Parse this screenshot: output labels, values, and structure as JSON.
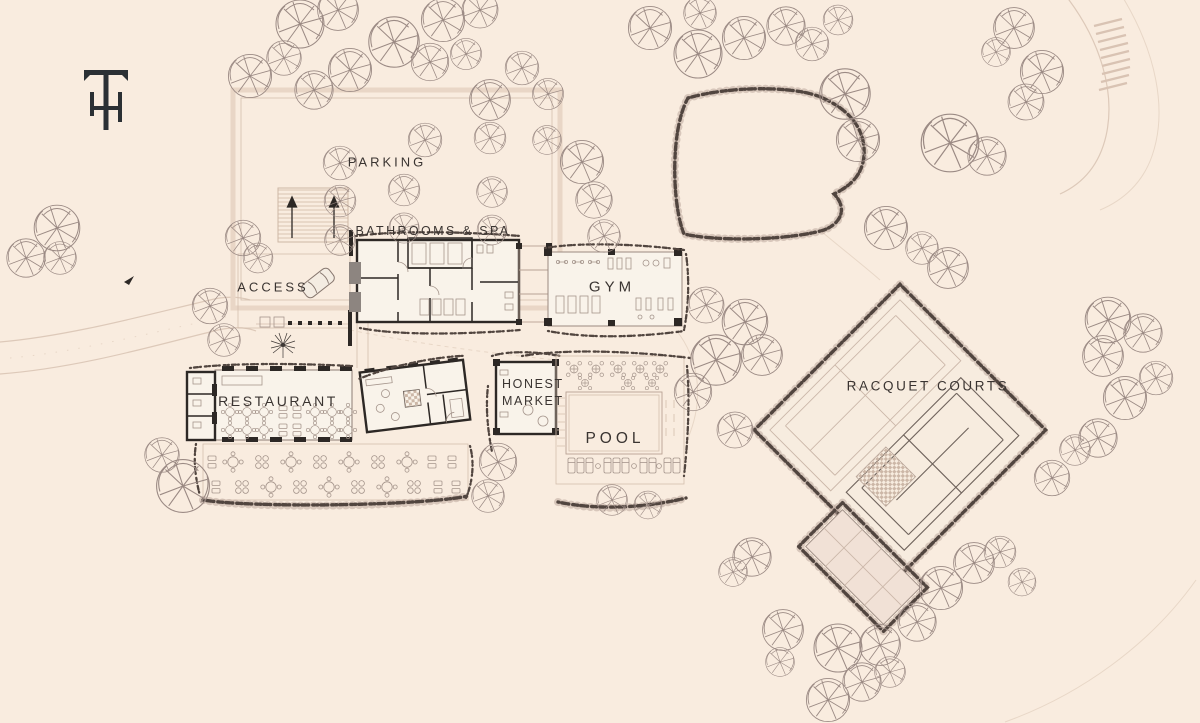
{
  "page": {
    "background": "#f9ecdf"
  },
  "branding": {
    "monogram": "TH"
  },
  "labels": {
    "parking": "PARKING",
    "bathrooms_spa": "BATHROOMS & SPA",
    "access": "ACCESS",
    "gym": "GYM",
    "restaurant": "RESTAURANT",
    "honest_market": {
      "lines": [
        "HONEST",
        "MARKET"
      ]
    },
    "pool": "POOL",
    "racquet_courts": "RACQUET COURTS"
  },
  "colors": {
    "background": "#f9ecdf",
    "ink": "#3a3431",
    "wall": "#2d2825",
    "tree_stroke": "#9b8a84",
    "hedge": "#51453f",
    "court_fill": "#f1e1d6",
    "road": "#ddc9b9"
  }
}
